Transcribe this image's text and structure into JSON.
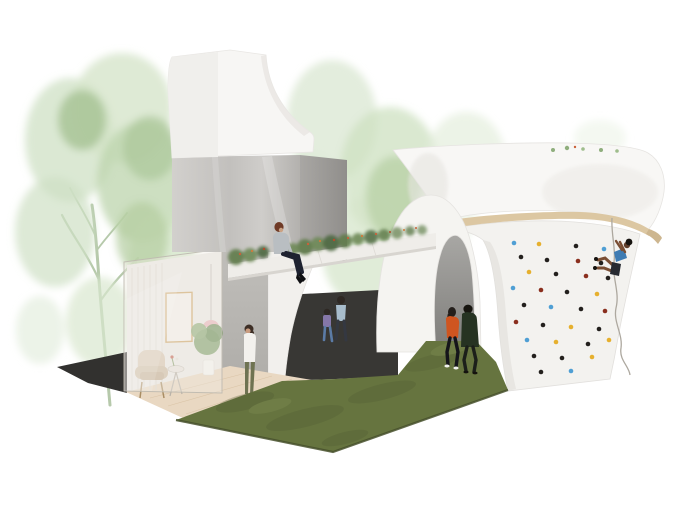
{
  "scene": {
    "kind": "architectural-concept-rendering",
    "description": "Axonometric collage rendering of a small cultural pavilion: white tower on gray cube, cutaway living room with glass facade, planted bridge walkway with seated woman, arched pavilion with flared canopy roof, climbing wall with climber on rope, grass strip with pedestrians, watercolor trees behind"
  },
  "colors": {
    "background": "#ffffff",
    "tower_front": "#f7f6f4",
    "tower_side": "#f0efec",
    "cube_front": "#c6c4c1",
    "cube_side": "#9e9c99",
    "canopy": "#f8f7f5",
    "canopy_edge_tan": "#dcc7a2",
    "canopy_curl_tan": "#cdb68f",
    "climb_wall": "#f3f2ef",
    "arch_white": "#f5f4f1",
    "arch_inner_top": "#a8a7a4",
    "arch_inner_bottom": "#7e7d7a",
    "dark_passage": "#383734",
    "dark_floor": "#32312f",
    "grass": "#66743f",
    "grass_edge": "#47502c",
    "wood_floor": "#e9d8c2",
    "room_back_wall": "#edebe7",
    "room_right_wall": "#b7b5b1",
    "glass": "rgba(240,236,229,0.42)",
    "bridge_fascia": "#efede9",
    "bridge_soffit": "#d8d5d0",
    "portal_white": "#f2f0ed",
    "tree_pale": "#dce9d4",
    "tree_light": "#cfe0c4",
    "tree_mid": "#b3cda0",
    "tree_dark": "#9fbd8c",
    "trunk": "#b6c9ab",
    "shrub_a": "#5f7b4b",
    "shrub_b": "#6e8a58",
    "shrub_c": "#4c6840",
    "flower_orange": "#c9613a",
    "flower_red": "#b54b2b",
    "rope": "#ada89f"
  },
  "climbing_wall": {
    "hold_colors": {
      "k": "#23201d",
      "r": "#8a2f1e",
      "b": "#4f9fd4",
      "y": "#e6b02e"
    },
    "holds": [
      {
        "x": 514,
        "y": 243,
        "c": "b"
      },
      {
        "x": 539,
        "y": 244,
        "c": "y"
      },
      {
        "x": 576,
        "y": 246,
        "c": "k"
      },
      {
        "x": 604,
        "y": 249,
        "c": "b"
      },
      {
        "x": 521,
        "y": 257,
        "c": "k"
      },
      {
        "x": 547,
        "y": 260,
        "c": "k"
      },
      {
        "x": 578,
        "y": 261,
        "c": "r"
      },
      {
        "x": 601,
        "y": 263,
        "c": "k"
      },
      {
        "x": 529,
        "y": 272,
        "c": "y"
      },
      {
        "x": 556,
        "y": 274,
        "c": "k"
      },
      {
        "x": 586,
        "y": 276,
        "c": "r"
      },
      {
        "x": 608,
        "y": 278,
        "c": "k"
      },
      {
        "x": 513,
        "y": 288,
        "c": "b"
      },
      {
        "x": 541,
        "y": 290,
        "c": "r"
      },
      {
        "x": 567,
        "y": 292,
        "c": "k"
      },
      {
        "x": 597,
        "y": 294,
        "c": "y"
      },
      {
        "x": 524,
        "y": 305,
        "c": "k"
      },
      {
        "x": 551,
        "y": 307,
        "c": "b"
      },
      {
        "x": 581,
        "y": 309,
        "c": "k"
      },
      {
        "x": 605,
        "y": 311,
        "c": "r"
      },
      {
        "x": 516,
        "y": 322,
        "c": "r"
      },
      {
        "x": 543,
        "y": 325,
        "c": "k"
      },
      {
        "x": 571,
        "y": 327,
        "c": "y"
      },
      {
        "x": 599,
        "y": 329,
        "c": "k"
      },
      {
        "x": 527,
        "y": 340,
        "c": "b"
      },
      {
        "x": 556,
        "y": 342,
        "c": "y"
      },
      {
        "x": 588,
        "y": 344,
        "c": "k"
      },
      {
        "x": 609,
        "y": 340,
        "c": "y"
      },
      {
        "x": 534,
        "y": 356,
        "c": "k"
      },
      {
        "x": 562,
        "y": 358,
        "c": "k"
      },
      {
        "x": 592,
        "y": 357,
        "c": "y"
      },
      {
        "x": 541,
        "y": 372,
        "c": "k"
      },
      {
        "x": 571,
        "y": 371,
        "c": "b"
      }
    ]
  },
  "people": [
    {
      "id": "seated-woman-on-bridge",
      "hair": "#6f3a26",
      "top": "#b9bec2",
      "pants": "#1e2230",
      "boots": "#0f0f12"
    },
    {
      "id": "standing-woman-in-room",
      "hair": "#3e2f26",
      "top": "#f3f1ed",
      "pants": "#6f7352"
    },
    {
      "id": "mother-in-passage",
      "hair": "#2e2823",
      "top": "#a8bdcc",
      "pants": "#343841"
    },
    {
      "id": "child-in-passage",
      "hair": "#2e2823",
      "top": "#8577a8",
      "pants": "#5b7ba6"
    },
    {
      "id": "walker-orange",
      "hair": "#241f1b",
      "top": "#cf5520",
      "pants": "#15151a",
      "shoes": "#f2f2ee"
    },
    {
      "id": "walker-coat",
      "hair": "#17150f",
      "top": "#263322",
      "pants": "#1c1f1a"
    },
    {
      "id": "climber-on-wall",
      "hair": "#16130f",
      "top": "#3f7cb3",
      "shorts": "#272a31",
      "skin": "#7a4e33"
    }
  ]
}
